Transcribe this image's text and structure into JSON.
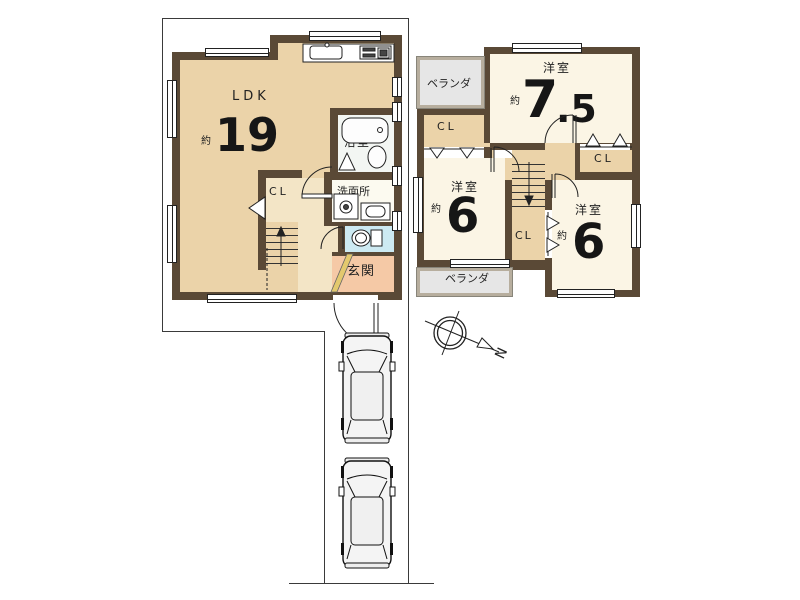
{
  "floor1": {
    "ldk": {
      "name": "LDK",
      "approx": "約",
      "area": "19"
    },
    "closet": {
      "name": "CL"
    },
    "bath": {
      "name": "浴室"
    },
    "washroom": {
      "name": "洗面所"
    },
    "entrance": {
      "name": "玄関"
    }
  },
  "floor2": {
    "room75": {
      "name": "洋室",
      "approx": "約",
      "area_main": "7",
      "area_fraction": ".5"
    },
    "room6_left": {
      "name": "洋室",
      "approx": "約",
      "area": "6"
    },
    "room6_right": {
      "name": "洋室",
      "approx": "約",
      "area": "6"
    },
    "closet_top_left": {
      "name": "CL"
    },
    "closet_right": {
      "name": "CL"
    },
    "closet_middle": {
      "name": "CL"
    },
    "veranda_top": {
      "name": "ベランダ"
    },
    "veranda_bottom": {
      "name": "ベランダ"
    }
  },
  "compass": {
    "north": "N"
  },
  "colors": {
    "wall": "#5a4936",
    "ldk_floor": "#ebd3a9",
    "hall_floor": "#f3e5c6",
    "room_floor": "#fbf5e5",
    "entrance_floor": "#f5c9a6",
    "toilet_floor": "#cdeaf2",
    "bath_floor": "#f3f6f3",
    "washroom_floor": "#fcfaf0",
    "veranda_floor": "#e6e6e6",
    "step_accent": "#e3c96e"
  }
}
